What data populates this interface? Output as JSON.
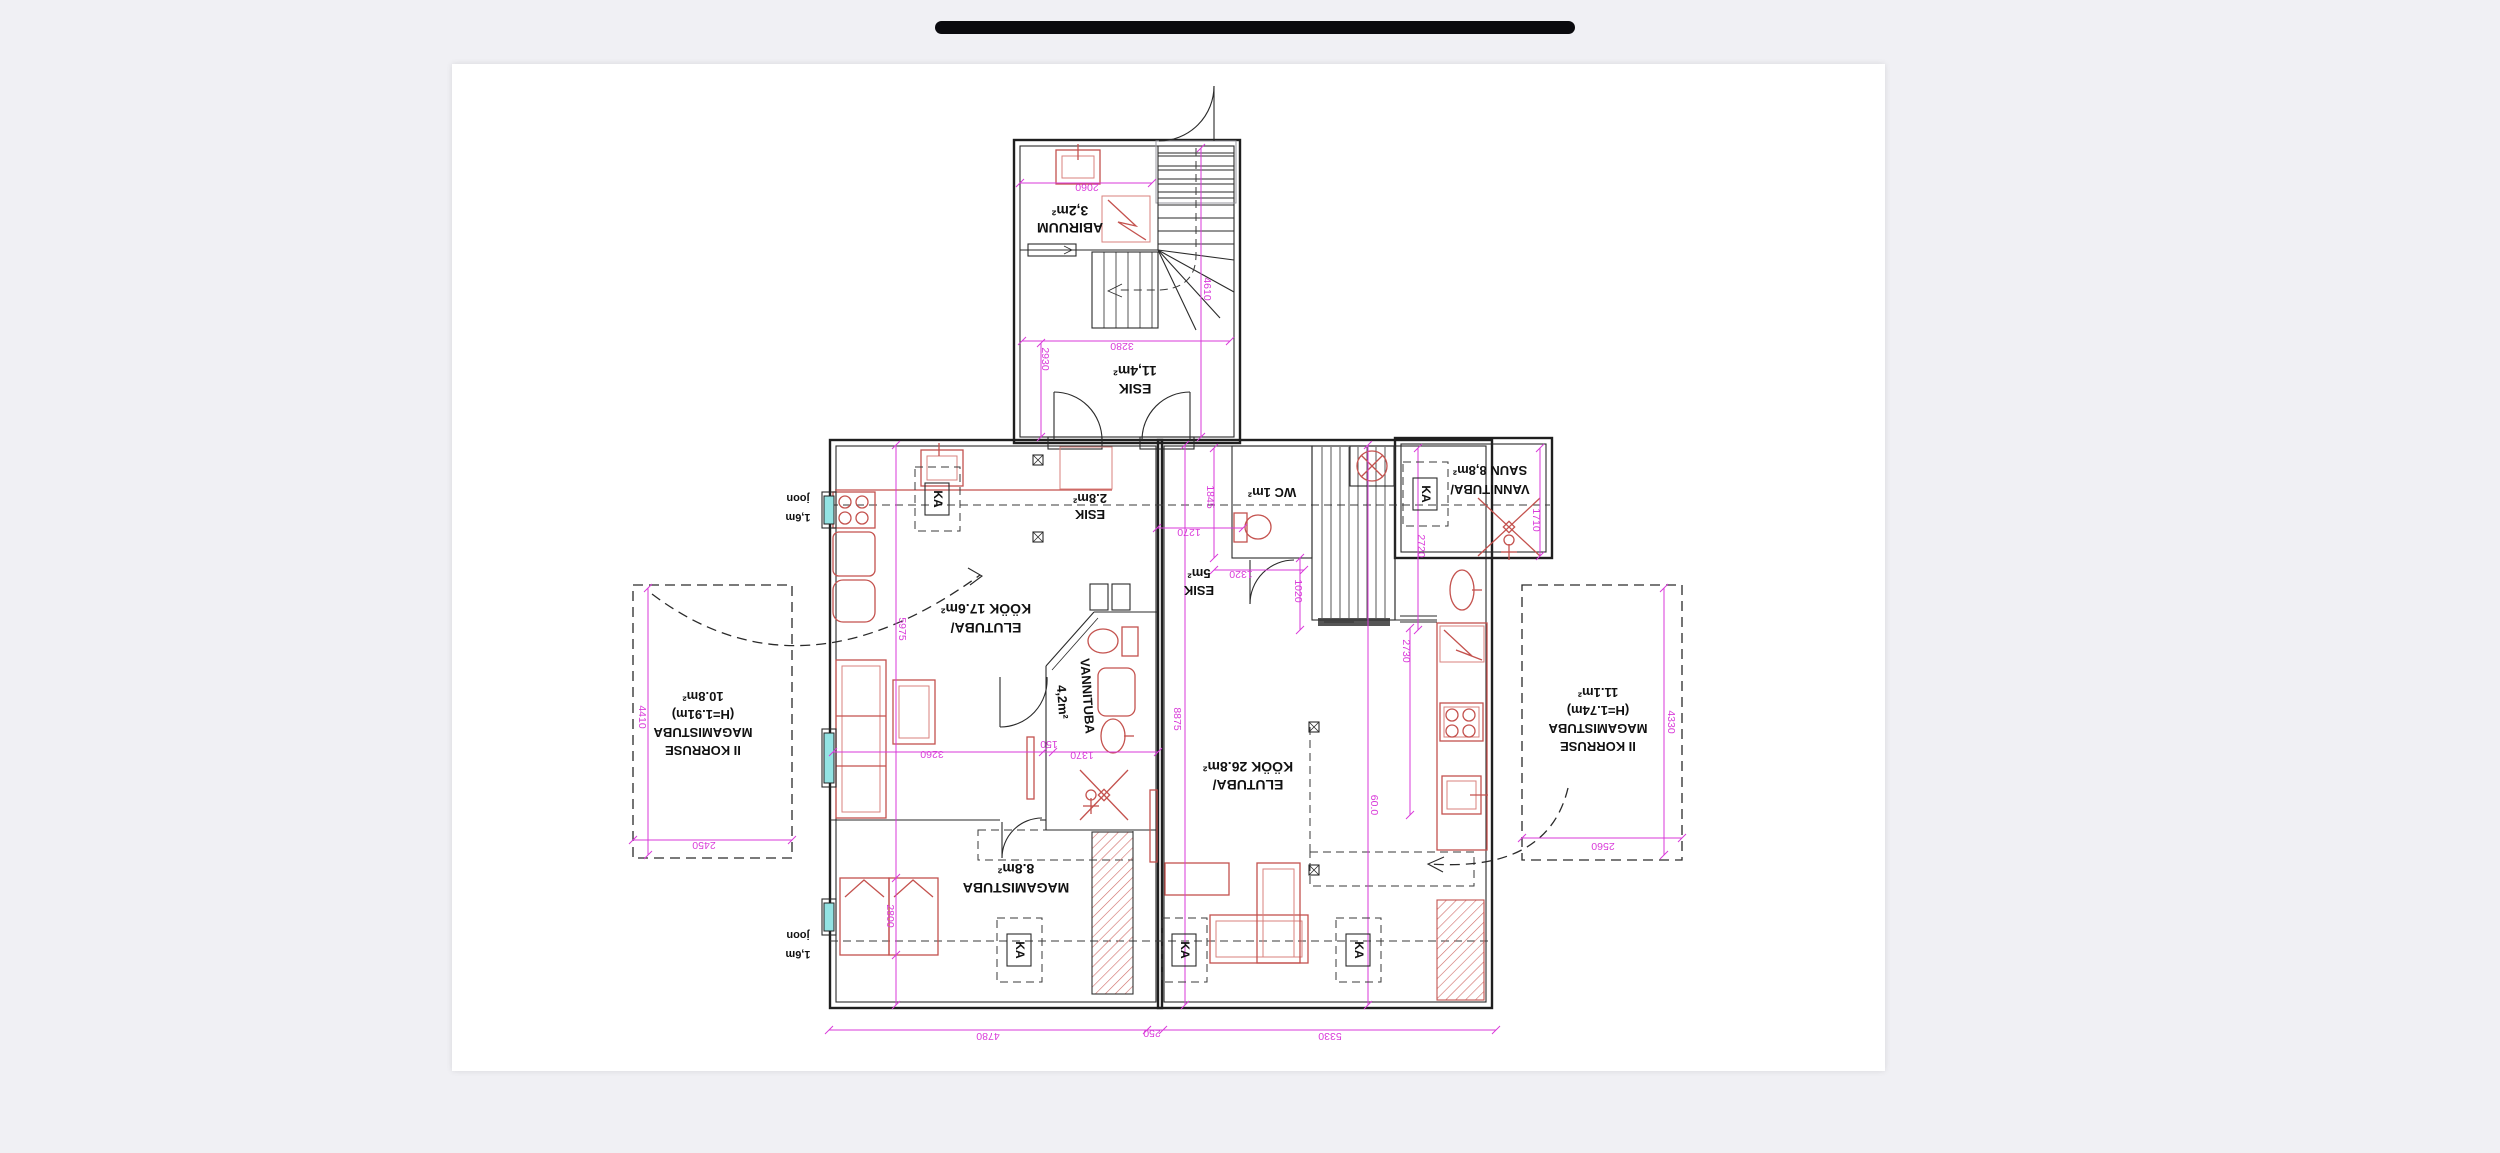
{
  "window": {
    "background": "#f0f0f4",
    "page_background": "#ffffff",
    "drag_handle_color": "#0a0a0e"
  },
  "colors": {
    "wall": "#1f1f1f",
    "furniture_red": "#c4524e",
    "dimension_magenta": "#d93ad9",
    "window_glass": "#93e3e3",
    "dashed_line": "#3a3a3a"
  },
  "plan": {
    "orientation_note": "plan rendered rotated 180 degrees",
    "room_labels": [
      {
        "name": "abiruum-label",
        "lines": [
          "3,2m²",
          "ABIRUUM"
        ],
        "x": 1070,
        "y": 214,
        "lh": 17,
        "size": 14,
        "rot": 180
      },
      {
        "name": "esik-11-label",
        "lines": [
          "11,4m²",
          "ESIK"
        ],
        "x": 1135,
        "y": 374,
        "lh": 18,
        "size": 14,
        "rot": 180
      },
      {
        "name": "esik-28-label",
        "lines": [
          "2.8m²",
          "ESIK"
        ],
        "x": 1090,
        "y": 502,
        "lh": 16,
        "size": 13,
        "rot": 180
      },
      {
        "name": "elutuba-kook-17-label",
        "lines": [
          "KÖÖK 17.6m²",
          "ELUTUBA/"
        ],
        "x": 986,
        "y": 612,
        "lh": 19,
        "size": 14,
        "rot": 180
      },
      {
        "name": "vannituba-42-label",
        "lines": [
          "VANNITUBA"
        ],
        "x": 1087,
        "y": 700,
        "lh": 18,
        "size": 13,
        "rot": 86
      },
      {
        "name": "vannituba-42-area",
        "lines": [
          "4,2m²"
        ],
        "x": 1062,
        "y": 706,
        "lh": 18,
        "size": 13,
        "rot": 86
      },
      {
        "name": "esik-5-label",
        "lines": [
          "5m²",
          "ESIK"
        ],
        "x": 1199,
        "y": 577,
        "lh": 17,
        "size": 13,
        "rot": 180
      },
      {
        "name": "wc-label",
        "lines": [
          "WC 1m²"
        ],
        "x": 1272,
        "y": 496,
        "lh": 17,
        "size": 13,
        "rot": 180
      },
      {
        "name": "vannituba-saun-label",
        "lines": [
          "SAUN 8,8m²",
          "VANNITUBA/"
        ],
        "x": 1490,
        "y": 474,
        "lh": 19,
        "size": 13,
        "rot": 180
      },
      {
        "name": "elutuba-kook-268-label",
        "lines": [
          "KÖÖK 26.8m²",
          "ELUTUBA/"
        ],
        "x": 1248,
        "y": 770,
        "lh": 18,
        "size": 14,
        "rot": 180
      },
      {
        "name": "magamistuba-88-label",
        "lines": [
          "8.8m²",
          "MAGAMISTUBA"
        ],
        "x": 1016,
        "y": 872,
        "lh": 19,
        "size": 14,
        "rot": 180
      },
      {
        "name": "korruse-left-label",
        "lines": [
          "10.8m²",
          "(H=1.91m)",
          "MAGAMISTUBA",
          "II KORRUSE"
        ],
        "x": 703,
        "y": 700,
        "lh": 18,
        "size": 13,
        "rot": 180
      },
      {
        "name": "korruse-right-label",
        "lines": [
          "11.1m²",
          "(H=1.74m)",
          "MAGAMISTUBA",
          "II KORRUSE"
        ],
        "x": 1598,
        "y": 696,
        "lh": 18,
        "size": 13,
        "rot": 180
      },
      {
        "name": "joon-top-label",
        "lines": [
          "joon",
          "1,6m"
        ],
        "x": 798,
        "y": 503,
        "lh": 19,
        "size": 11,
        "rot": 180
      },
      {
        "name": "joon-bottom-label",
        "lines": [
          "joon",
          "1,6m"
        ],
        "x": 798,
        "y": 940,
        "lh": 19,
        "size": 11,
        "rot": 180
      }
    ],
    "dimensions": [
      {
        "text": "2060",
        "x": 1087,
        "y": 190,
        "rot": 180
      },
      {
        "text": "3280",
        "x": 1122,
        "y": 349,
        "rot": 180
      },
      {
        "text": "2930",
        "x": 1045,
        "y": 362,
        "rot": 90
      },
      {
        "text": "4610",
        "x": 1207,
        "y": 292,
        "rot": 90
      },
      {
        "text": "4780",
        "x": 988,
        "y": 1039,
        "rot": 180
      },
      {
        "text": "250",
        "x": 1152,
        "y": 1036,
        "rot": 180
      },
      {
        "text": "5330",
        "x": 1330,
        "y": 1039,
        "rot": 180
      },
      {
        "text": "5975",
        "x": 902,
        "y": 632,
        "rot": 90
      },
      {
        "text": "2800",
        "x": 890,
        "y": 919,
        "rot": 90
      },
      {
        "text": "3260",
        "x": 932,
        "y": 757,
        "rot": 180
      },
      {
        "text": "150",
        "x": 1049,
        "y": 747,
        "rot": 180
      },
      {
        "text": "1370",
        "x": 1082,
        "y": 758,
        "rot": 180
      },
      {
        "text": "8875",
        "x": 1177,
        "y": 722,
        "rot": 90
      },
      {
        "text": "60.0",
        "x": 1374,
        "y": 808,
        "rot": 90
      },
      {
        "text": "2720",
        "x": 1421,
        "y": 549,
        "rot": 90
      },
      {
        "text": "2730",
        "x": 1406,
        "y": 654,
        "rot": 90
      },
      {
        "text": "1710",
        "x": 1536,
        "y": 523,
        "rot": 90
      },
      {
        "text": "1845",
        "x": 1210,
        "y": 500,
        "rot": 90
      },
      {
        "text": "1020",
        "x": 1298,
        "y": 594,
        "rot": 90
      },
      {
        "text": "1270",
        "x": 1189,
        "y": 535,
        "rot": 180
      },
      {
        "text": "1320",
        "x": 1241,
        "y": 577,
        "rot": 180
      },
      {
        "text": "2450",
        "x": 704,
        "y": 848,
        "rot": 180
      },
      {
        "text": "4410",
        "x": 642,
        "y": 720,
        "rot": 90
      },
      {
        "text": "2560",
        "x": 1603,
        "y": 849,
        "rot": 180
      },
      {
        "text": "4330",
        "x": 1671,
        "y": 725,
        "rot": 90
      }
    ],
    "ka_markers": [
      {
        "label": "KA",
        "x": 925,
        "y": 483
      },
      {
        "label": "KA",
        "x": 1413,
        "y": 478
      },
      {
        "label": "KA",
        "x": 1007,
        "y": 934
      },
      {
        "label": "KA",
        "x": 1172,
        "y": 934
      },
      {
        "label": "KA",
        "x": 1346,
        "y": 934
      }
    ],
    "sockets": [
      {
        "x": 1038,
        "y": 460
      },
      {
        "x": 1038,
        "y": 537
      },
      {
        "x": 1314,
        "y": 727
      },
      {
        "x": 1314,
        "y": 870
      }
    ]
  }
}
